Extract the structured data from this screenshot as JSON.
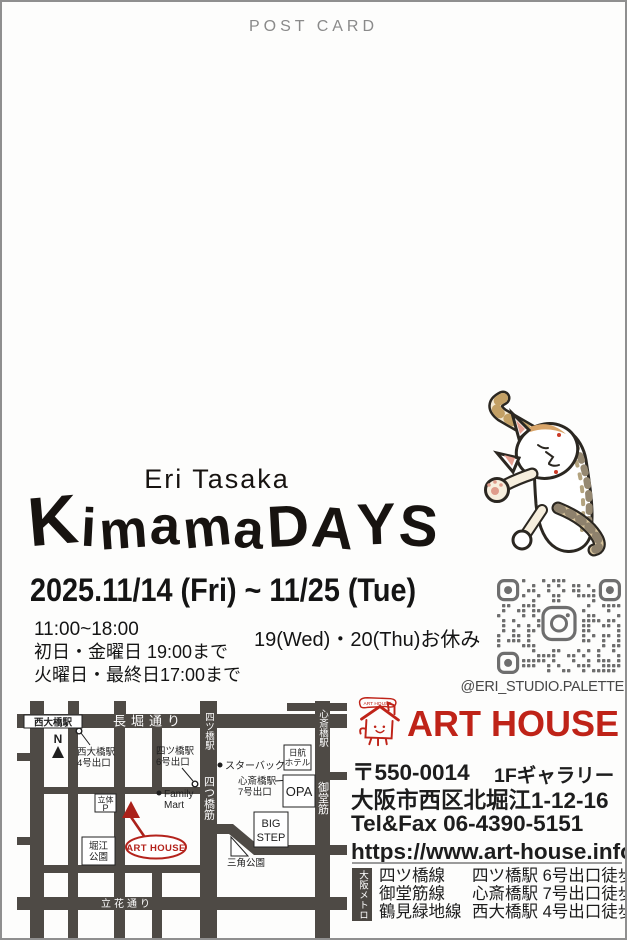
{
  "postcard_label": "POST CARD",
  "artist": "Eri Tasaka",
  "title": "Kimama DAYS",
  "schedule": {
    "dates": "2025.11/14 (Fri) ~ 11/25 (Tue)",
    "hours": "11:00~18:00",
    "hours_note_1": "初日・金曜日 19:00まで",
    "hours_note_2": "火曜日・最終日17:00まで",
    "closed": "19(Wed)・20(Thu)お休み"
  },
  "instagram": {
    "handle": "@ERI_STUDIO.PALETTE"
  },
  "venue": {
    "name": "ART HOUSE",
    "postal_code": "〒550-0014",
    "floor": "1Fギャラリー",
    "address": "大阪市西区北堀江1-12-16",
    "tel": "Tel&Fax 06-4390-5151",
    "url": "https://www.art-house.info/"
  },
  "metro": {
    "label": "大阪メトロ",
    "lines": [
      {
        "name": "四ツ橋線",
        "access": "四ツ橋駅 6号出口徒歩1分"
      },
      {
        "name": "御堂筋線",
        "access": "心斎橋駅 7号出口徒歩8分"
      },
      {
        "name": "鶴見緑地線",
        "access": "西大橋駅 4号出口徒歩6分"
      }
    ]
  },
  "map": {
    "station_nishiohashi": "西大橋駅",
    "road_nagahori": "長堀通り",
    "north_label": "N",
    "exit_nishiohashi_1": "西大橋駅",
    "exit_nishiohashi_2": "4号出口",
    "exit_yotsubashi_1": "四ツ橋駅",
    "exit_yotsubashi_2": "6号出口",
    "station_yotsubashi": "四ツ橋駅",
    "road_yotsubashisuji": "四つ橋筋",
    "station_shinsaibashi": "心斎橋駅",
    "road_midosuji": "御堂筋",
    "starbucks": "スターバックス",
    "hotel_1": "日航",
    "hotel_2": "ホテル",
    "exit_shinsaibashi_1": "心斎橋駅",
    "exit_shinsaibashi_2": "7号出口",
    "opa": "OPA",
    "bigstep_1": "BIG",
    "bigstep_2": "STEP",
    "triangle_park": "三角公園",
    "parking_1": "立体",
    "parking_2": "P",
    "familymart_1": "Family",
    "familymart_2": "Mart",
    "horie_park_1": "堀江",
    "horie_park_2": "公園",
    "arthouse": "ART HOUSE",
    "road_tachibana": "立花通り"
  },
  "colors": {
    "accent_red": "#bf2318",
    "road_gray": "#4e4a45",
    "qr_gray": "#6e6e6e",
    "muted_gray": "#8a8a8a"
  }
}
